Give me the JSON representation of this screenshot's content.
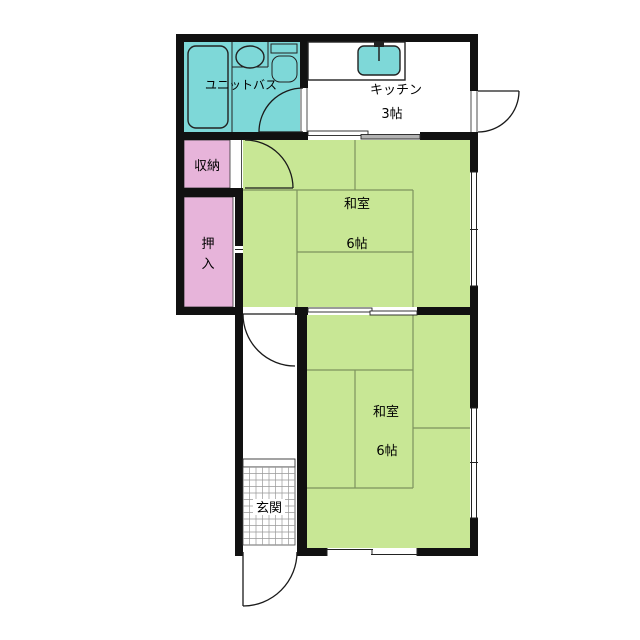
{
  "title": "Japanese apartment floor plan",
  "colors": {
    "wall_black": "#111111",
    "bath_cyan": "#7ed8d8",
    "tatami_green": "#c8e795",
    "tatami_line": "#7d935e",
    "closet_pink": "#e7b4da",
    "panel_grey": "#b3b3b3",
    "grid_grey": "#999999",
    "outline_dark": "#222222"
  },
  "rooms": {
    "unit_bath": {
      "label": "ユニットバス"
    },
    "kitchen": {
      "label": "キッチン",
      "size": "3帖"
    },
    "storage": {
      "label": "収納"
    },
    "oshiire": {
      "label": "押入",
      "char1": "押",
      "char2": "入"
    },
    "washitsu_middle": {
      "label": "和室",
      "size": "6帖"
    },
    "washitsu_bottom": {
      "label": "和室",
      "size": "6帖"
    },
    "genkan": {
      "label": "玄関"
    }
  }
}
